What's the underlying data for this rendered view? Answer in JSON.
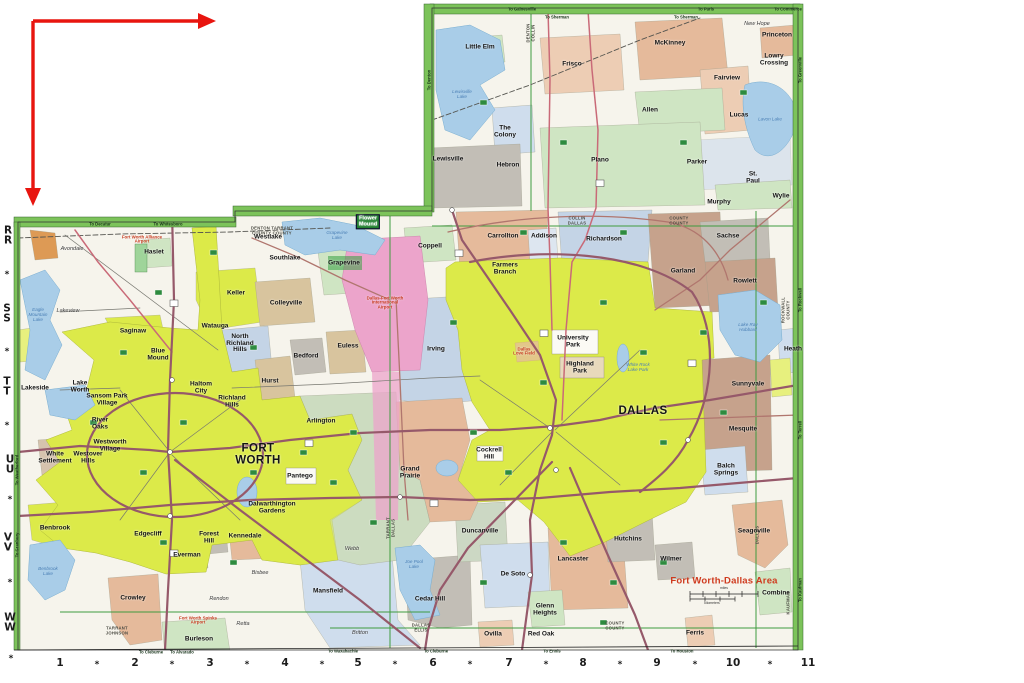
{
  "annotation": {
    "arrow_color": "#e8150f"
  },
  "map": {
    "title": "Fort Worth-Dallas Area",
    "colors": {
      "title_red": "#cf3a1e",
      "border_green": "#7cc35a",
      "water_blue": "#a9cde8",
      "city_yellow": "#dcea49",
      "airport_pink": "#eca4cb",
      "freeway_maroon": "#96596a",
      "arrow_red": "#e8150f"
    },
    "scale": {
      "miles": "miles",
      "kilometers": "kilometers"
    },
    "grid": {
      "rows": [
        {
          "t": "R\nR",
          "x": 8,
          "y": 236
        },
        {
          "t": "*",
          "x": 7,
          "y": 275
        },
        {
          "t": "S\nS",
          "x": 7,
          "y": 314
        },
        {
          "t": "*",
          "x": 7,
          "y": 352
        },
        {
          "t": "T\nT",
          "x": 7,
          "y": 387
        },
        {
          "t": "*",
          "x": 7,
          "y": 426
        },
        {
          "t": "U\nU",
          "x": 10,
          "y": 465
        },
        {
          "t": "*",
          "x": 10,
          "y": 500
        },
        {
          "t": "V\nV",
          "x": 8,
          "y": 543
        },
        {
          "t": "*",
          "x": 10,
          "y": 583
        },
        {
          "t": "W\nW",
          "x": 10,
          "y": 623
        },
        {
          "t": "*",
          "x": 11,
          "y": 659
        }
      ],
      "cols": [
        {
          "t": "1",
          "x": 60,
          "y": 664
        },
        {
          "t": "*",
          "x": 97,
          "y": 665
        },
        {
          "t": "2",
          "x": 135,
          "y": 664
        },
        {
          "t": "*",
          "x": 172,
          "y": 665
        },
        {
          "t": "3",
          "x": 210,
          "y": 664
        },
        {
          "t": "*",
          "x": 247,
          "y": 665
        },
        {
          "t": "4",
          "x": 285,
          "y": 664
        },
        {
          "t": "*",
          "x": 322,
          "y": 665
        },
        {
          "t": "5",
          "x": 358,
          "y": 664
        },
        {
          "t": "*",
          "x": 395,
          "y": 665
        },
        {
          "t": "6",
          "x": 433,
          "y": 664
        },
        {
          "t": "*",
          "x": 470,
          "y": 665
        },
        {
          "t": "7",
          "x": 509,
          "y": 664
        },
        {
          "t": "*",
          "x": 546,
          "y": 665
        },
        {
          "t": "8",
          "x": 583,
          "y": 664
        },
        {
          "t": "*",
          "x": 620,
          "y": 665
        },
        {
          "t": "9",
          "x": 657,
          "y": 664
        },
        {
          "t": "*",
          "x": 695,
          "y": 665
        },
        {
          "t": "10",
          "x": 733,
          "y": 664
        },
        {
          "t": "*",
          "x": 770,
          "y": 665
        },
        {
          "t": "11",
          "x": 808,
          "y": 664
        }
      ]
    },
    "cities": [
      {
        "n": "Little Elm",
        "x": 480,
        "y": 48
      },
      {
        "n": "Frisco",
        "x": 572,
        "y": 65
      },
      {
        "n": "McKinney",
        "x": 670,
        "y": 44
      },
      {
        "n": "New Hope",
        "x": 757,
        "y": 25,
        "c": "small"
      },
      {
        "n": "Princeton",
        "x": 777,
        "y": 36
      },
      {
        "n": "Lowry\nCrossing",
        "x": 774,
        "y": 60
      },
      {
        "n": "Fairview",
        "x": 727,
        "y": 79
      },
      {
        "n": "Allen",
        "x": 650,
        "y": 111
      },
      {
        "n": "Lucas",
        "x": 739,
        "y": 116
      },
      {
        "n": "The\nColony",
        "x": 505,
        "y": 132
      },
      {
        "n": "Lewisville",
        "x": 448,
        "y": 160
      },
      {
        "n": "Hebron",
        "x": 508,
        "y": 166
      },
      {
        "n": "Plano",
        "x": 600,
        "y": 161
      },
      {
        "n": "Parker",
        "x": 697,
        "y": 163
      },
      {
        "n": "St.\nPaul",
        "x": 753,
        "y": 178
      },
      {
        "n": "Murphy",
        "x": 719,
        "y": 203
      },
      {
        "n": "Wylie",
        "x": 781,
        "y": 197
      },
      {
        "n": "Avondale",
        "x": 72,
        "y": 250,
        "c": "small"
      },
      {
        "n": "Haslet",
        "x": 154,
        "y": 253
      },
      {
        "n": "Lakeview",
        "x": 68,
        "y": 312,
        "c": "small"
      },
      {
        "n": "Saginaw",
        "x": 133,
        "y": 332
      },
      {
        "n": "Keller",
        "x": 236,
        "y": 294
      },
      {
        "n": "Watauga",
        "x": 215,
        "y": 327
      },
      {
        "n": "North\nRichland\nHills",
        "x": 240,
        "y": 344
      },
      {
        "n": "Blue\nMound",
        "x": 158,
        "y": 355
      },
      {
        "n": "Haltom\nCity",
        "x": 201,
        "y": 388
      },
      {
        "n": "Richland\nHills",
        "x": 232,
        "y": 402
      },
      {
        "n": "Lakeside",
        "x": 35,
        "y": 389
      },
      {
        "n": "Lake\nWorth",
        "x": 80,
        "y": 387
      },
      {
        "n": "Sansom Park\nVillage",
        "x": 107,
        "y": 400
      },
      {
        "n": "River\nOaks",
        "x": 100,
        "y": 424
      },
      {
        "n": "Westworth\nVillage",
        "x": 110,
        "y": 446
      },
      {
        "n": "Westover\nHills",
        "x": 88,
        "y": 458
      },
      {
        "n": "White\nSettlement",
        "x": 55,
        "y": 458
      },
      {
        "n": "FORT\nWORTH",
        "x": 258,
        "y": 455,
        "c": "big"
      },
      {
        "n": "Hurst",
        "x": 270,
        "y": 382
      },
      {
        "n": "Bedford",
        "x": 306,
        "y": 357
      },
      {
        "n": "Euless",
        "x": 348,
        "y": 347
      },
      {
        "n": "Colleyville",
        "x": 286,
        "y": 304
      },
      {
        "n": "Southlake",
        "x": 285,
        "y": 259
      },
      {
        "n": "Westlake",
        "x": 268,
        "y": 238
      },
      {
        "n": "Grapevine",
        "x": 344,
        "y": 264
      },
      {
        "n": "Flower\nMound",
        "x": 368,
        "y": 222,
        "c": "boxed"
      },
      {
        "n": "Coppell",
        "x": 430,
        "y": 247
      },
      {
        "n": "Carrollton",
        "x": 503,
        "y": 237
      },
      {
        "n": "Addison",
        "x": 544,
        "y": 237
      },
      {
        "n": "Richardson",
        "x": 604,
        "y": 240
      },
      {
        "n": "Farmers\nBranch",
        "x": 505,
        "y": 269
      },
      {
        "n": "Garland",
        "x": 683,
        "y": 272
      },
      {
        "n": "Sachse",
        "x": 728,
        "y": 237
      },
      {
        "n": "Rowlett",
        "x": 745,
        "y": 282
      },
      {
        "n": "Heath",
        "x": 793,
        "y": 350
      },
      {
        "n": "Sunnyvale",
        "x": 748,
        "y": 385
      },
      {
        "n": "Mesquite",
        "x": 743,
        "y": 430
      },
      {
        "n": "University\nPark",
        "x": 573,
        "y": 342
      },
      {
        "n": "Highland\nPark",
        "x": 580,
        "y": 368
      },
      {
        "n": "DALLAS",
        "x": 643,
        "y": 412,
        "c": "big"
      },
      {
        "n": "Irving",
        "x": 436,
        "y": 350
      },
      {
        "n": "Arlington",
        "x": 321,
        "y": 422
      },
      {
        "n": "Pantego",
        "x": 300,
        "y": 477
      },
      {
        "n": "Dalwarthington\nGardens",
        "x": 272,
        "y": 508
      },
      {
        "n": "Grand\nPrairie",
        "x": 410,
        "y": 473
      },
      {
        "n": "Cockrell\nHill",
        "x": 489,
        "y": 454
      },
      {
        "n": "Forest\nHill",
        "x": 209,
        "y": 538
      },
      {
        "n": "Everman",
        "x": 187,
        "y": 556
      },
      {
        "n": "Edgecliff",
        "x": 148,
        "y": 535
      },
      {
        "n": "Kennedale",
        "x": 245,
        "y": 537
      },
      {
        "n": "Benbrook",
        "x": 55,
        "y": 529
      },
      {
        "n": "Crowley",
        "x": 133,
        "y": 599
      },
      {
        "n": "Burleson",
        "x": 199,
        "y": 640
      },
      {
        "n": "Rendon",
        "x": 219,
        "y": 600,
        "c": "small"
      },
      {
        "n": "Retta",
        "x": 243,
        "y": 625,
        "c": "small"
      },
      {
        "n": "Mansfield",
        "x": 328,
        "y": 592
      },
      {
        "n": "Bisbee",
        "x": 260,
        "y": 574,
        "c": "small"
      },
      {
        "n": "Webb",
        "x": 352,
        "y": 550,
        "c": "small"
      },
      {
        "n": "Britton",
        "x": 360,
        "y": 634,
        "c": "small"
      },
      {
        "n": "Duncanville",
        "x": 480,
        "y": 532
      },
      {
        "n": "Cedar Hill",
        "x": 430,
        "y": 600
      },
      {
        "n": "De Soto",
        "x": 513,
        "y": 575
      },
      {
        "n": "Lancaster",
        "x": 573,
        "y": 560
      },
      {
        "n": "Glenn\nHeights",
        "x": 545,
        "y": 610
      },
      {
        "n": "Ovilla",
        "x": 493,
        "y": 635
      },
      {
        "n": "Red Oak",
        "x": 541,
        "y": 635
      },
      {
        "n": "Hutchins",
        "x": 628,
        "y": 540
      },
      {
        "n": "Wilmer",
        "x": 671,
        "y": 560
      },
      {
        "n": "Ferris",
        "x": 695,
        "y": 634
      },
      {
        "n": "Balch\nSprings",
        "x": 726,
        "y": 470
      },
      {
        "n": "Seagoville",
        "x": 754,
        "y": 532
      },
      {
        "n": "Combine",
        "x": 776,
        "y": 594
      },
      {
        "n": "Fort Worth Alliance\nAirport",
        "x": 142,
        "y": 240,
        "c": "red"
      },
      {
        "n": "Dallas-Fort Worth\nInternational\nAirport",
        "x": 385,
        "y": 303,
        "c": "red"
      },
      {
        "n": "Dallas\nLove Field",
        "x": 524,
        "y": 352,
        "c": "red"
      },
      {
        "n": "Fort Worth Spinks\nAirport",
        "x": 198,
        "y": 621,
        "c": "red"
      }
    ],
    "water_labels": [
      {
        "t": "Eagle\nMountain\nLake",
        "x": 38,
        "y": 315
      },
      {
        "t": "Grapevine\nLake",
        "x": 337,
        "y": 236
      },
      {
        "t": "Lewisville\nLake",
        "x": 462,
        "y": 95
      },
      {
        "t": "Lavon Lake",
        "x": 770,
        "y": 120
      },
      {
        "t": "Lake Ray\nHubbard",
        "x": 748,
        "y": 328
      },
      {
        "t": "Joe Pool\nLake",
        "x": 414,
        "y": 565
      },
      {
        "t": "Benbrook\nLake",
        "x": 48,
        "y": 572
      },
      {
        "t": "White Rock\nLake Park",
        "x": 638,
        "y": 368
      }
    ],
    "county_labels": [
      {
        "t": "DENTON  TARRANT\nCOUNTY  COUNTY",
        "x": 272,
        "y": 231
      },
      {
        "t": "COLLIN\nDALLAS",
        "x": 577,
        "y": 221
      },
      {
        "t": "COUNTY\nCOUNTY",
        "x": 679,
        "y": 221
      },
      {
        "t": "DENTON\nCOLLIN",
        "x": 531,
        "y": 33,
        "v": 1
      },
      {
        "t": "TARRANT\nDALLAS",
        "x": 391,
        "y": 528,
        "v": 1
      },
      {
        "t": "TARRANT\nJOHNSON",
        "x": 117,
        "y": 631
      },
      {
        "t": "DALLAS\nELLIS",
        "x": 421,
        "y": 628
      },
      {
        "t": "COUNTY\nCOUNTY",
        "x": 615,
        "y": 626
      },
      {
        "t": "ROCKWALL\nCOUNTY",
        "x": 786,
        "y": 310,
        "v": 1
      },
      {
        "t": "DALLAS",
        "x": 758,
        "y": 535,
        "v": 1
      },
      {
        "t": "KAUFMAN",
        "x": 789,
        "y": 603,
        "v": 1
      }
    ],
    "edge_labels": [
      {
        "t": "To Gainesville",
        "x": 522,
        "y": 9
      },
      {
        "t": "To Sherman",
        "x": 557,
        "y": 17
      },
      {
        "t": "To Paris",
        "x": 706,
        "y": 9
      },
      {
        "t": "To Sherman",
        "x": 686,
        "y": 17
      },
      {
        "t": "To Commerce",
        "x": 788,
        "y": 9
      },
      {
        "t": "To Decatur",
        "x": 100,
        "y": 224
      },
      {
        "t": "To Whitesboro",
        "x": 168,
        "y": 224
      },
      {
        "t": "To Denton",
        "x": 429,
        "y": 80,
        "v": 1
      },
      {
        "t": "To Greenville",
        "x": 800,
        "y": 70,
        "v": 1
      },
      {
        "t": "To Rockwall",
        "x": 800,
        "y": 300,
        "v": 1
      },
      {
        "t": "To Terrell",
        "x": 800,
        "y": 430,
        "v": 1
      },
      {
        "t": "To Kaufman",
        "x": 800,
        "y": 590,
        "v": 1
      },
      {
        "t": "To Weatherford",
        "x": 17,
        "y": 470,
        "v": 1
      },
      {
        "t": "To Granbury",
        "x": 17,
        "y": 545,
        "v": 1
      },
      {
        "t": "To Cleburne",
        "x": 151,
        "y": 652
      },
      {
        "t": "To Alvarado",
        "x": 182,
        "y": 652
      },
      {
        "t": "To Waxahachie",
        "x": 343,
        "y": 651
      },
      {
        "t": "To Cleburne",
        "x": 436,
        "y": 651
      },
      {
        "t": "To Ennis",
        "x": 552,
        "y": 651
      },
      {
        "t": "To Houston",
        "x": 682,
        "y": 651
      }
    ]
  }
}
